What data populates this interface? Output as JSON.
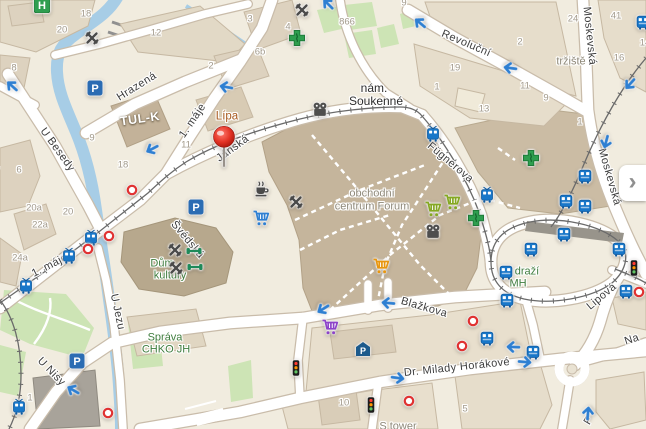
{
  "map": {
    "colors": {
      "background": "#f1ecdf",
      "water": "#a7cde6",
      "green_area": "#cde4b5",
      "road_fill": "#ffffff",
      "road_casing": "#c9bcaa",
      "building": "#ddd2bf",
      "building_major": "#c5b59c",
      "building_dark": "#b7a88d",
      "accent_blue": "#1877c9",
      "arrow_blue": "#2e7fd2",
      "stop_red": "#e03131",
      "poi_green": "#3f7d3e",
      "poi_brown": "#a8591e",
      "pin_red": "#d92b1f"
    },
    "panel_button": {
      "glyph": "›"
    },
    "street_labels": [
      {
        "text": "Hrazená",
        "x": 137,
        "y": 87,
        "rot": -32
      },
      {
        "text": "U Besedy",
        "x": 57,
        "y": 150,
        "rot": 54
      },
      {
        "text": "1. máje",
        "x": 193,
        "y": 121,
        "rot": -56
      },
      {
        "text": "1. máje",
        "x": 50,
        "y": 266,
        "rot": -27
      },
      {
        "text": "Jánská",
        "x": 233,
        "y": 149,
        "rot": -36
      },
      {
        "text": "Švédská",
        "x": 187,
        "y": 240,
        "rot": 50
      },
      {
        "text": "Revoluční",
        "x": 466,
        "y": 44,
        "rot": 23
      },
      {
        "text": "Moskevská",
        "x": 589,
        "y": 36,
        "rot": 84
      },
      {
        "text": "Moskevská",
        "x": 609,
        "y": 177,
        "rot": 74
      },
      {
        "text": "Fügnerova",
        "x": 450,
        "y": 163,
        "rot": 40
      },
      {
        "text": "Blažkova",
        "x": 424,
        "y": 308,
        "rot": 16
      },
      {
        "text": "Dr. Milady Horákové",
        "x": 457,
        "y": 368,
        "rot": -6
      },
      {
        "text": "Lipová",
        "x": 602,
        "y": 297,
        "rot": -40
      },
      {
        "text": "U Jezu",
        "x": 117,
        "y": 312,
        "rot": 78
      },
      {
        "text": "U Nisy",
        "x": 51,
        "y": 372,
        "rot": 46
      },
      {
        "text": "Na",
        "x": 632,
        "y": 340,
        "rot": -18
      },
      {
        "text": "F",
        "x": 589,
        "y": 421,
        "rot": -60
      },
      {
        "text": "Rybníčku",
        "x": -6,
        "y": 190,
        "rot": -83
      }
    ],
    "house_numbers": [
      {
        "text": "18",
        "x": 86,
        "y": 14
      },
      {
        "text": "20",
        "x": 62,
        "y": 30
      },
      {
        "text": "8",
        "x": 14,
        "y": 68
      },
      {
        "text": "12",
        "x": 156,
        "y": 33
      },
      {
        "text": "2",
        "x": 211,
        "y": 66
      },
      {
        "text": "9",
        "x": 92,
        "y": 138
      },
      {
        "text": "11",
        "x": 186,
        "y": 145
      },
      {
        "text": "3",
        "x": 250,
        "y": 19
      },
      {
        "text": "4",
        "x": 288,
        "y": 27
      },
      {
        "text": "6b",
        "x": 260,
        "y": 52
      },
      {
        "text": "866",
        "x": 347,
        "y": 22
      },
      {
        "text": "9",
        "x": 404,
        "y": 3
      },
      {
        "text": "24",
        "x": 573,
        "y": 19
      },
      {
        "text": "41",
        "x": 616,
        "y": 16
      },
      {
        "text": "2",
        "x": 520,
        "y": 42
      },
      {
        "text": "19",
        "x": 455,
        "y": 68
      },
      {
        "text": "1",
        "x": 437,
        "y": 87
      },
      {
        "text": "13",
        "x": 484,
        "y": 109
      },
      {
        "text": "11",
        "x": 525,
        "y": 86
      },
      {
        "text": "9",
        "x": 546,
        "y": 98
      },
      {
        "text": "16",
        "x": 619,
        "y": 58
      },
      {
        "text": "14",
        "x": 645,
        "y": 43
      },
      {
        "text": "1",
        "x": 580,
        "y": 122
      },
      {
        "text": "6",
        "x": 19,
        "y": 170
      },
      {
        "text": "18",
        "x": 123,
        "y": 165
      },
      {
        "text": "20a",
        "x": 34,
        "y": 208
      },
      {
        "text": "20",
        "x": 68,
        "y": 212
      },
      {
        "text": "22a",
        "x": 40,
        "y": 225
      },
      {
        "text": "24a",
        "x": 20,
        "y": 258
      },
      {
        "text": "1",
        "x": 30,
        "y": 398
      },
      {
        "text": "10",
        "x": 344,
        "y": 403
      },
      {
        "text": "5",
        "x": 465,
        "y": 409
      }
    ],
    "poi_labels": [
      {
        "text": "Lípa",
        "x": 227,
        "y": 117,
        "cls": "poi-brown"
      },
      {
        "text": "TUL-K",
        "x": 140,
        "y": 119,
        "cls": "poi-white",
        "rot": -8
      },
      {
        "text": "nám.",
        "x": 374,
        "y": 88,
        "cls": "poi-black"
      },
      {
        "text": "Soukenné",
        "x": 376,
        "y": 101,
        "cls": "poi-black"
      },
      {
        "text": "obchodní",
        "x": 372,
        "y": 194,
        "cls": "poi-gray"
      },
      {
        "text": "centrum Forum",
        "x": 372,
        "y": 207,
        "cls": "poi-gray"
      },
      {
        "text": "tržiště",
        "x": 571,
        "y": 62,
        "cls": "poi-gray"
      },
      {
        "text": "Dům",
        "x": 162,
        "y": 264,
        "cls": "poi-green"
      },
      {
        "text": "kultury",
        "x": 170,
        "y": 276,
        "cls": "poi-green"
      },
      {
        "text": "Správa",
        "x": 165,
        "y": 338,
        "cls": "poi-green"
      },
      {
        "text": "CHKO JH",
        "x": 166,
        "y": 350,
        "cls": "poi-green"
      },
      {
        "text": "draží",
        "x": 527,
        "y": 272,
        "cls": "poi-green"
      },
      {
        "text": "MH",
        "x": 518,
        "y": 284,
        "cls": "poi-green"
      },
      {
        "text": "S tower",
        "x": 398,
        "y": 427,
        "cls": "poi-gray"
      }
    ],
    "icons": [
      {
        "type": "pin",
        "x": 224,
        "y": 167
      },
      {
        "type": "tram",
        "x": 91,
        "y": 238
      },
      {
        "type": "tram",
        "x": 69,
        "y": 256
      },
      {
        "type": "tram",
        "x": 26,
        "y": 286
      },
      {
        "type": "tram",
        "x": 19,
        "y": 407
      },
      {
        "type": "tram",
        "x": 433,
        "y": 134
      },
      {
        "type": "tram",
        "x": 487,
        "y": 195
      },
      {
        "type": "bus",
        "x": 643,
        "y": 22
      },
      {
        "type": "bus",
        "x": 585,
        "y": 176
      },
      {
        "type": "bus",
        "x": 566,
        "y": 201
      },
      {
        "type": "bus",
        "x": 585,
        "y": 206
      },
      {
        "type": "bus",
        "x": 564,
        "y": 234
      },
      {
        "type": "bus",
        "x": 531,
        "y": 249
      },
      {
        "type": "bus",
        "x": 619,
        "y": 249
      },
      {
        "type": "bus",
        "x": 506,
        "y": 272
      },
      {
        "type": "bus",
        "x": 507,
        "y": 300
      },
      {
        "type": "bus",
        "x": 626,
        "y": 291
      },
      {
        "type": "bus",
        "x": 487,
        "y": 338
      },
      {
        "type": "bus",
        "x": 533,
        "y": 352
      },
      {
        "type": "parking",
        "x": 95,
        "y": 88
      },
      {
        "type": "parking",
        "x": 196,
        "y": 207
      },
      {
        "type": "parking",
        "x": 77,
        "y": 361
      },
      {
        "type": "covered-parking",
        "x": 363,
        "y": 349
      },
      {
        "type": "pharmacy",
        "x": 297,
        "y": 38
      },
      {
        "type": "pharmacy",
        "x": 531,
        "y": 158
      },
      {
        "type": "pharmacy",
        "x": 476,
        "y": 218
      },
      {
        "type": "hospital",
        "x": 42,
        "y": 5
      },
      {
        "type": "restaurant",
        "x": 92,
        "y": 38
      },
      {
        "type": "restaurant",
        "x": 302,
        "y": 10
      },
      {
        "type": "restaurant",
        "x": 296,
        "y": 202
      },
      {
        "type": "restaurant",
        "x": 175,
        "y": 250
      },
      {
        "type": "restaurant",
        "x": 176,
        "y": 268
      },
      {
        "type": "cafe",
        "x": 261,
        "y": 188
      },
      {
        "type": "cart",
        "x": 261,
        "y": 218,
        "color": "#2e7fd2"
      },
      {
        "type": "cart",
        "x": 433,
        "y": 209,
        "color": "#85a823"
      },
      {
        "type": "cart",
        "x": 452,
        "y": 202,
        "color": "#85a823"
      },
      {
        "type": "cart",
        "x": 381,
        "y": 266,
        "color": "#e8960f"
      },
      {
        "type": "cart",
        "x": 330,
        "y": 327,
        "color": "#8d43c9"
      },
      {
        "type": "cinema",
        "x": 320,
        "y": 110
      },
      {
        "type": "cinema",
        "x": 433,
        "y": 232
      },
      {
        "type": "dumbbell",
        "x": 194,
        "y": 251
      },
      {
        "type": "dumbbell",
        "x": 195,
        "y": 267
      },
      {
        "type": "traffic-light",
        "x": 296,
        "y": 368
      },
      {
        "type": "traffic-light",
        "x": 371,
        "y": 405
      },
      {
        "type": "traffic-light",
        "x": 634,
        "y": 268
      },
      {
        "type": "stop",
        "x": 132,
        "y": 190
      },
      {
        "type": "stop",
        "x": 109,
        "y": 236
      },
      {
        "type": "stop",
        "x": 88,
        "y": 249
      },
      {
        "type": "stop",
        "x": 108,
        "y": 413
      },
      {
        "type": "stop",
        "x": 473,
        "y": 321
      },
      {
        "type": "stop",
        "x": 462,
        "y": 346
      },
      {
        "type": "stop",
        "x": 409,
        "y": 401
      },
      {
        "type": "stop",
        "x": 639,
        "y": 292
      },
      {
        "type": "arrow",
        "x": 12,
        "y": 86,
        "rot": -138
      },
      {
        "type": "arrow",
        "x": 152,
        "y": 149,
        "rot": 152
      },
      {
        "type": "arrow",
        "x": 226,
        "y": 87,
        "rot": 190
      },
      {
        "type": "arrow",
        "x": 328,
        "y": 4,
        "rot": -135
      },
      {
        "type": "arrow",
        "x": 420,
        "y": 23,
        "rot": -140
      },
      {
        "type": "arrow",
        "x": 510,
        "y": 68,
        "rot": 188
      },
      {
        "type": "arrow",
        "x": 630,
        "y": 84,
        "rot": 132
      },
      {
        "type": "arrow",
        "x": 606,
        "y": 142,
        "rot": 105
      },
      {
        "type": "arrow",
        "x": 323,
        "y": 309,
        "rot": 148
      },
      {
        "type": "arrow",
        "x": 388,
        "y": 303,
        "rot": 185
      },
      {
        "type": "arrow",
        "x": 513,
        "y": 347,
        "rot": 182
      },
      {
        "type": "arrow",
        "x": 525,
        "y": 362,
        "rot": 5
      },
      {
        "type": "arrow",
        "x": 398,
        "y": 378,
        "rot": 8
      },
      {
        "type": "arrow",
        "x": 73,
        "y": 390,
        "rot": -150
      },
      {
        "type": "arrow",
        "x": 588,
        "y": 413,
        "rot": -85
      }
    ]
  }
}
